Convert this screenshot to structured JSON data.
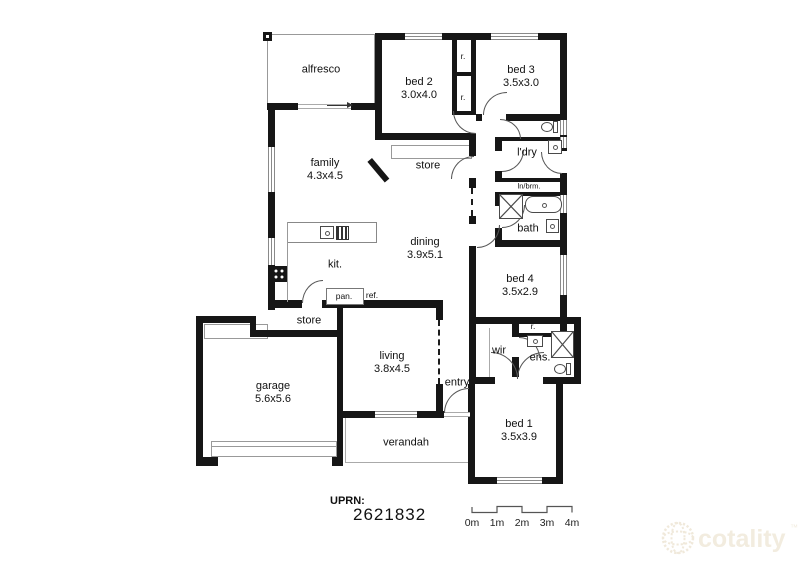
{
  "rooms": {
    "alfresco": {
      "name": "alfresco"
    },
    "bed2": {
      "name": "bed 2",
      "dims": "3.0x4.0"
    },
    "bed3": {
      "name": "bed 3",
      "dims": "3.5x3.0"
    },
    "family": {
      "name": "family",
      "dims": "4.3x4.5"
    },
    "store_top": {
      "name": "store"
    },
    "ldry": {
      "name": "l'dry"
    },
    "lnbrm": {
      "name": "ln/brm."
    },
    "bath": {
      "name": "bath"
    },
    "dining": {
      "name": "dining",
      "dims": "3.9x5.1"
    },
    "kit": {
      "name": "kit."
    },
    "bed4": {
      "name": "bed 4",
      "dims": "3.5x2.9"
    },
    "pan": {
      "name": "pan."
    },
    "ref": {
      "name": "ref."
    },
    "store_bottom": {
      "name": "store"
    },
    "garage": {
      "name": "garage",
      "dims": "5.6x5.6"
    },
    "living": {
      "name": "living",
      "dims": "3.8x4.5"
    },
    "entry": {
      "name": "entry"
    },
    "wir": {
      "name": "wir"
    },
    "ens": {
      "name": "ens."
    },
    "bed1": {
      "name": "bed 1",
      "dims": "3.5x3.9"
    },
    "verandah": {
      "name": "verandah"
    },
    "robe1": {
      "name": "r."
    },
    "robe2": {
      "name": "r."
    },
    "robe3": {
      "name": "r."
    }
  },
  "footer": {
    "uprn_label": "UPRN:",
    "uprn_value": "2621832",
    "scale_ticks": [
      "0m",
      "1m",
      "2m",
      "3m",
      "4m"
    ]
  },
  "branding": {
    "logo_text": "cotality",
    "trademark": "™"
  },
  "colors": {
    "wall": "#161616",
    "window": "#8a8a8a",
    "fixture": "#4a4a4a",
    "logo": "#f2ecdf"
  }
}
